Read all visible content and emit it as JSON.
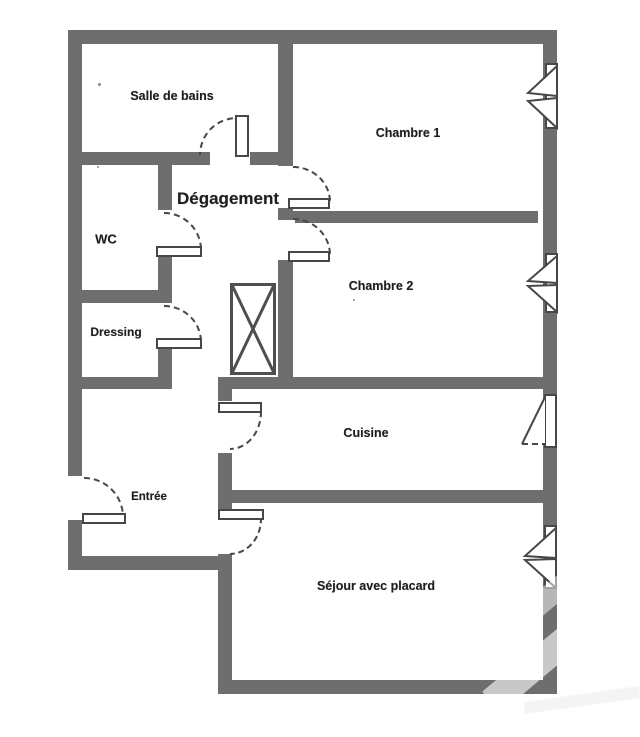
{
  "floorplan": {
    "title": "Apartment floor plan",
    "rooms": [
      {
        "id": "salle-de-bains",
        "label": "Salle de bains"
      },
      {
        "id": "chambre-1",
        "label": "Chambre 1"
      },
      {
        "id": "degagement",
        "label": "Dégagement"
      },
      {
        "id": "wc",
        "label": "WC"
      },
      {
        "id": "chambre-2",
        "label": "Chambre 2"
      },
      {
        "id": "dressing",
        "label": "Dressing"
      },
      {
        "id": "cuisine",
        "label": "Cuisine"
      },
      {
        "id": "entree",
        "label": "Entrée"
      },
      {
        "id": "sejour",
        "label": "Séjour avec placard"
      }
    ],
    "colors": {
      "wall": "#6e6e6e",
      "line": "#474747",
      "text": "#1e1e1e",
      "background": "#ffffff"
    }
  }
}
